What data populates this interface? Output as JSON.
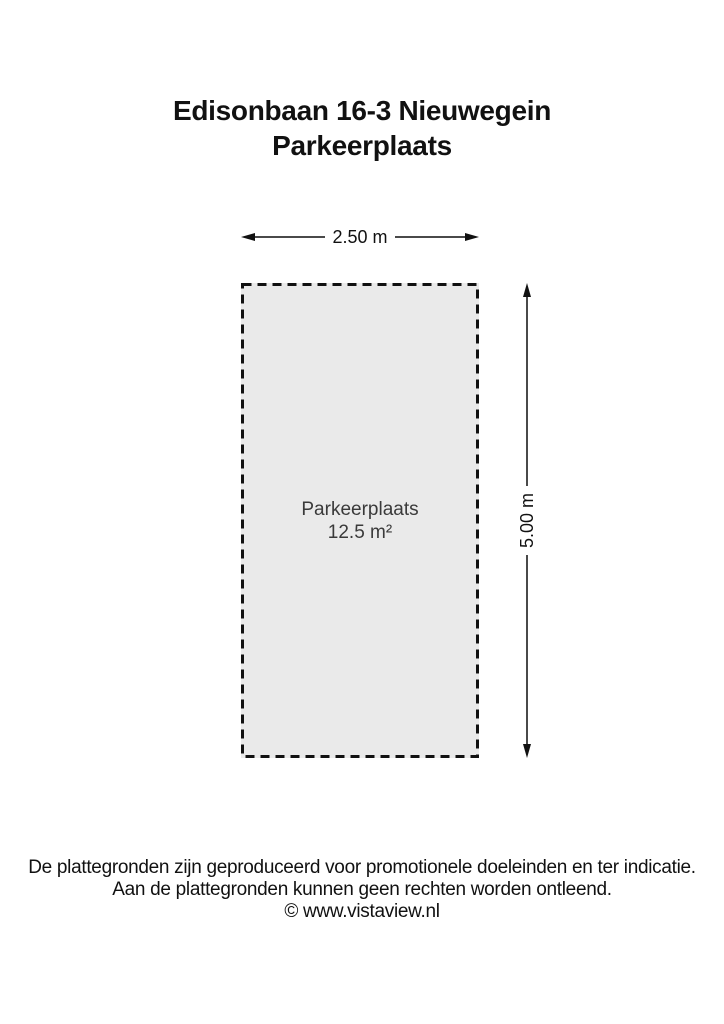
{
  "header": {
    "title_line1": "Edisonbaan 16-3 Nieuwegein",
    "title_line2": "Parkeerplaats"
  },
  "plan": {
    "width_dimension": "2.50 m",
    "height_dimension": "5.00 m",
    "space_name": "Parkeerplaats",
    "space_area": "12.5 m²",
    "colors": {
      "space_fill": "#eaeaea",
      "outline": "#111111",
      "dimension_line": "#4a4a4a",
      "space_label_text": "#3a3a3a"
    }
  },
  "footer": {
    "disclaimer_line1": "De plattegronden zijn geproduceerd voor promotionele doeleinden en ter indicatie.",
    "disclaimer_line2": "Aan de plattegronden kunnen geen rechten worden ontleend.",
    "copyright": "© www.vistaview.nl"
  }
}
